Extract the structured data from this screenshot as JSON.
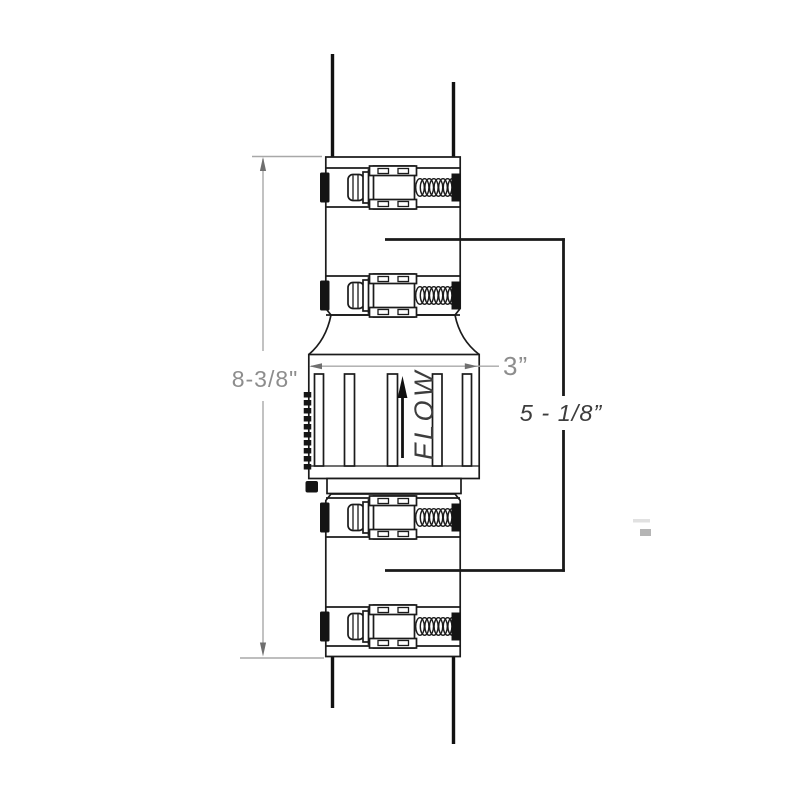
{
  "diagram": {
    "flow_label": "FLOW",
    "dimensions": {
      "overall_height": "8-3/8\"",
      "body_width": "3”",
      "coupling_to_coupling": "5 - 1/8”"
    },
    "colors": {
      "line": "#1b1b1b",
      "dimension_line": "#a8a8a8",
      "dimension_text": "#8d8d8d",
      "annotation_text": "#3d3d3d",
      "background": "#ffffff"
    }
  }
}
